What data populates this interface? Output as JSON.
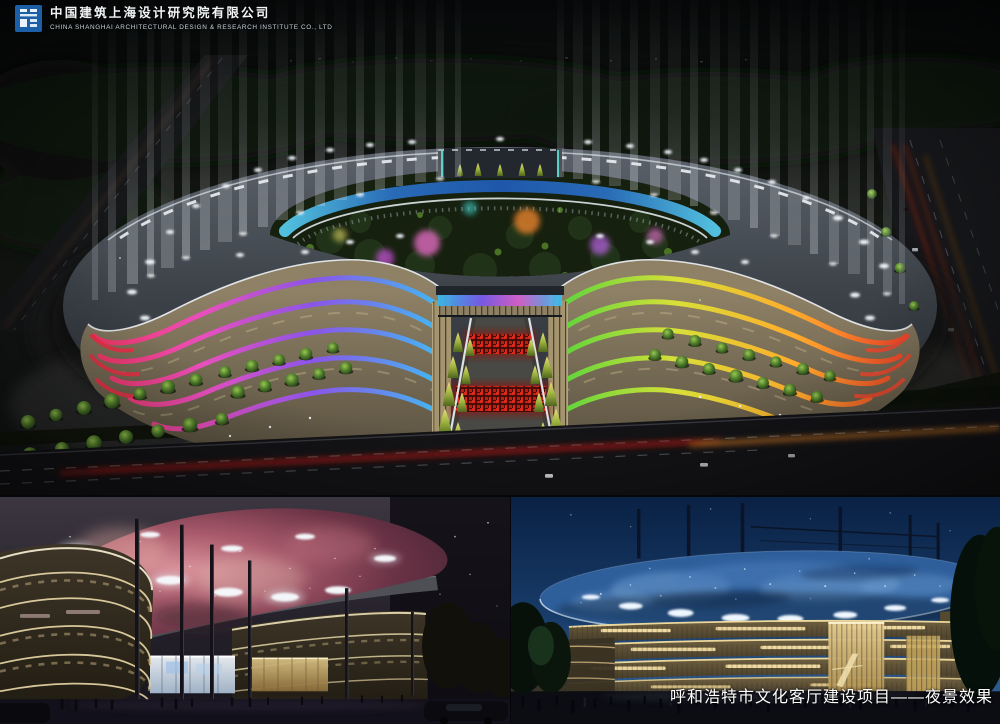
{
  "header": {
    "company_name_zh": "中国建筑上海设计研究院有限公司",
    "company_name_en": "CHINA SHANGHAI ARCHITECTURAL DESIGN & RESEARCH INSTITUTE CO., LTD"
  },
  "caption": {
    "project_title": "呼和浩特市文化客厅建设项目——夜景效果"
  },
  "colors": {
    "logo_blue": "#1d5fa6",
    "band_red": "#f5365e",
    "band_cyan": "#3cc2f2",
    "band_green": "#4ed43c",
    "band_orange": "#ffab2c",
    "glass_blue": "#1f5ab2",
    "red_carpet": "#d8291a",
    "nebula_pink": "#a85a6b",
    "dusk_sky": "#173a67",
    "facade_warm": "#f4df9f"
  }
}
